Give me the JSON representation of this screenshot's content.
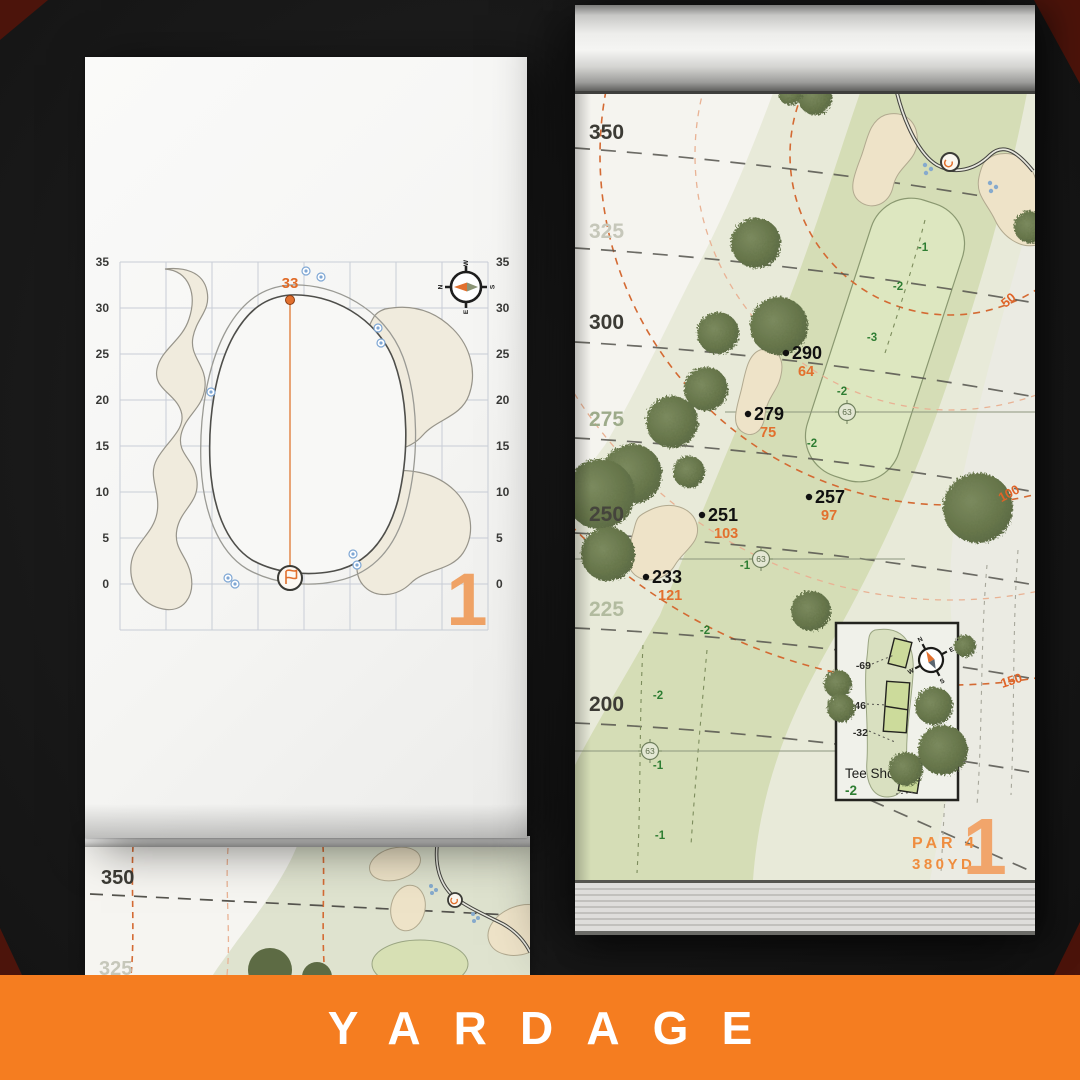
{
  "banner": {
    "label": "YARDAGE",
    "bg_color": "#f57d20"
  },
  "colors": {
    "accent_orange": "#f57d20",
    "map_orange": "#d46a33",
    "number_orange": "#e2702e",
    "fairway_green": "#d5ddb6",
    "rough_green": "#e8ead9",
    "tree_green": "#66754a",
    "bunker_sand": "#eee3c8",
    "slope_green": "#2e7d32"
  },
  "compass": {
    "n": "N",
    "e": "E",
    "s": "S",
    "w": "W"
  },
  "left_page": {
    "pin_distance": "33",
    "hole_number": "1",
    "axis": [
      "35",
      "30",
      "25",
      "20",
      "15",
      "10",
      "5",
      "0"
    ]
  },
  "right_page": {
    "hole_number": "1",
    "par_label": "PAR 4",
    "yardage_label": "380YD",
    "distance_labels": [
      "350",
      "325",
      "300",
      "275",
      "250",
      "225",
      "200"
    ],
    "arc_labels": [
      "50",
      "100",
      "150"
    ],
    "sprinkler_label": "63",
    "slopes": [
      "-1",
      "-2",
      "-3",
      "-2",
      "-2",
      "-1",
      "-2",
      "-2",
      "-1",
      "-1"
    ],
    "points": [
      {
        "yards": "290",
        "pin": "64"
      },
      {
        "yards": "279",
        "pin": "75"
      },
      {
        "yards": "257",
        "pin": "97"
      },
      {
        "yards": "251",
        "pin": "103"
      },
      {
        "yards": "233",
        "pin": "121"
      }
    ],
    "tee_box": {
      "title": "Tee Shot",
      "slope": "-2",
      "offsets": [
        "-69",
        "-46",
        "-32"
      ]
    }
  },
  "partial_page": {
    "distance_labels": [
      "350",
      "325"
    ]
  }
}
